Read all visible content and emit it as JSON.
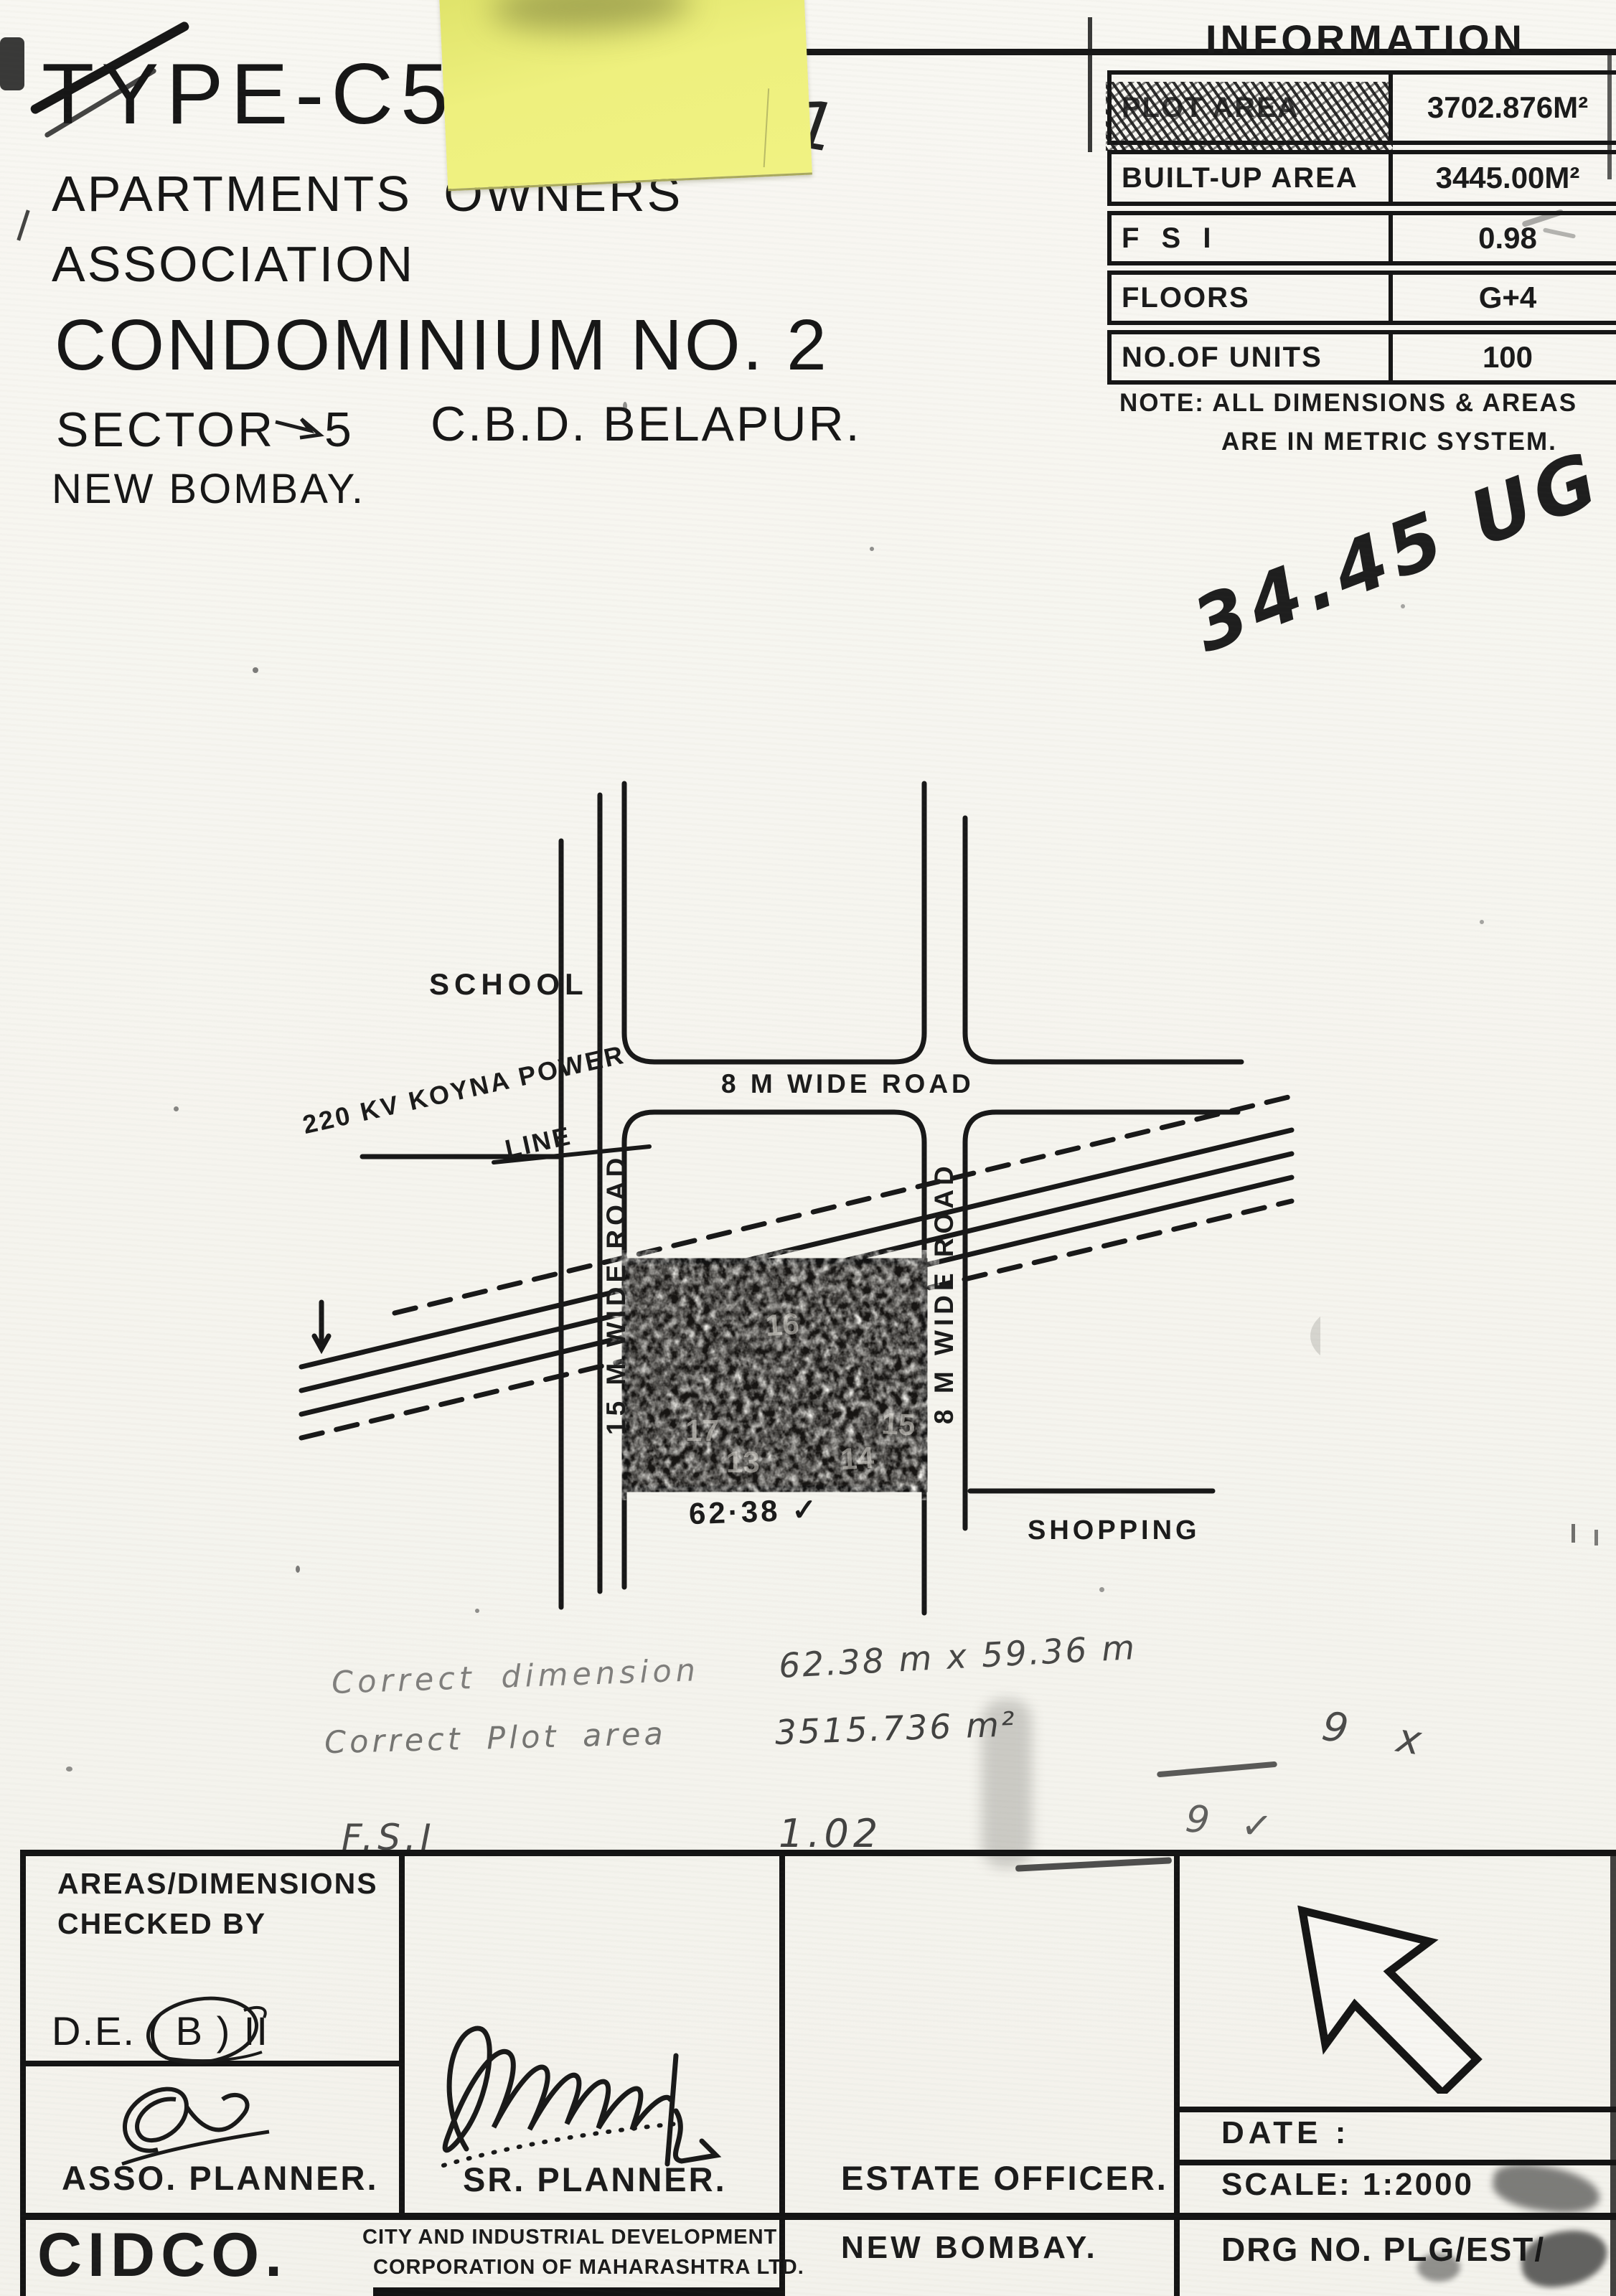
{
  "header": {
    "line1": "TYPE-C5",
    "line2": "APARTMENTS OWNERS",
    "line3": "ASSOCIATION",
    "line4": "CONDOMINIUM NO. 2",
    "line5a": "SECTOR",
    "line5b": "5",
    "line5c": "C.B.D. BELAPUR.",
    "line6": "NEW BOMBAY."
  },
  "info_table": {
    "title": "INFORMATION",
    "rows": [
      {
        "label": "PLOT AREA",
        "value": "3702.876M²"
      },
      {
        "label": "BUILT-UP AREA",
        "value": "3445.00M²"
      },
      {
        "label": "F S I",
        "value": "0.98"
      },
      {
        "label": "FLOORS",
        "value": "G+4"
      },
      {
        "label": "NO.OF UNITS",
        "value": "100"
      }
    ],
    "note_line1": "NOTE: ALL DIMENSIONS & AREAS",
    "note_line2": "ARE IN METRIC SYSTEM."
  },
  "handwriting": {
    "sheet_mark": "161",
    "area_note": "34.45 UG",
    "correction_line1_label": "Correct dimension",
    "correction_line1_value": "62.38 m x 59.36 m",
    "correction_line2_label": "Correct Plot area",
    "correction_line2_value": "3515.736 m²",
    "correction_line2_mark": "9 x",
    "correction_line3_label": "F.S.I",
    "correction_line3_value": "1.02",
    "correction_line3_mark": "9 ✓"
  },
  "site_plan": {
    "school": "SCHOOL",
    "road_top": "8 M WIDE ROAD",
    "power_line_1": "220 KV KOYNA POWER",
    "power_line_2": "LINE",
    "road_left": "15 M WIDE ROAD",
    "road_right": "8 M WIDE ROAD",
    "shopping": "SHOPPING",
    "plot_dimension": "62·38 ✓",
    "plot_numbers": {
      "n1": "16",
      "n2": "17",
      "n3": "15",
      "n4": "13",
      "n5": "14"
    }
  },
  "title_block": {
    "checked_by_line1": "AREAS/DIMENSIONS",
    "checked_by_line2": "CHECKED BY",
    "de_line": "D.E. ( B ) II",
    "asso_planner": "ASSO. PLANNER.",
    "sr_planner": "SR. PLANNER.",
    "estate_officer": "ESTATE OFFICER.",
    "date_label": "DATE :",
    "scale_label": "SCALE: 1:2000",
    "drg_no": "DRG NO. PLG/EST/",
    "cidco": "CIDCO.",
    "cidco_line1": "CITY AND INDUSTRIAL DEVELOPMENT",
    "cidco_line2": "CORPORATION OF MAHARASHTRA LTD.",
    "new_bombay": "NEW BOMBAY."
  }
}
